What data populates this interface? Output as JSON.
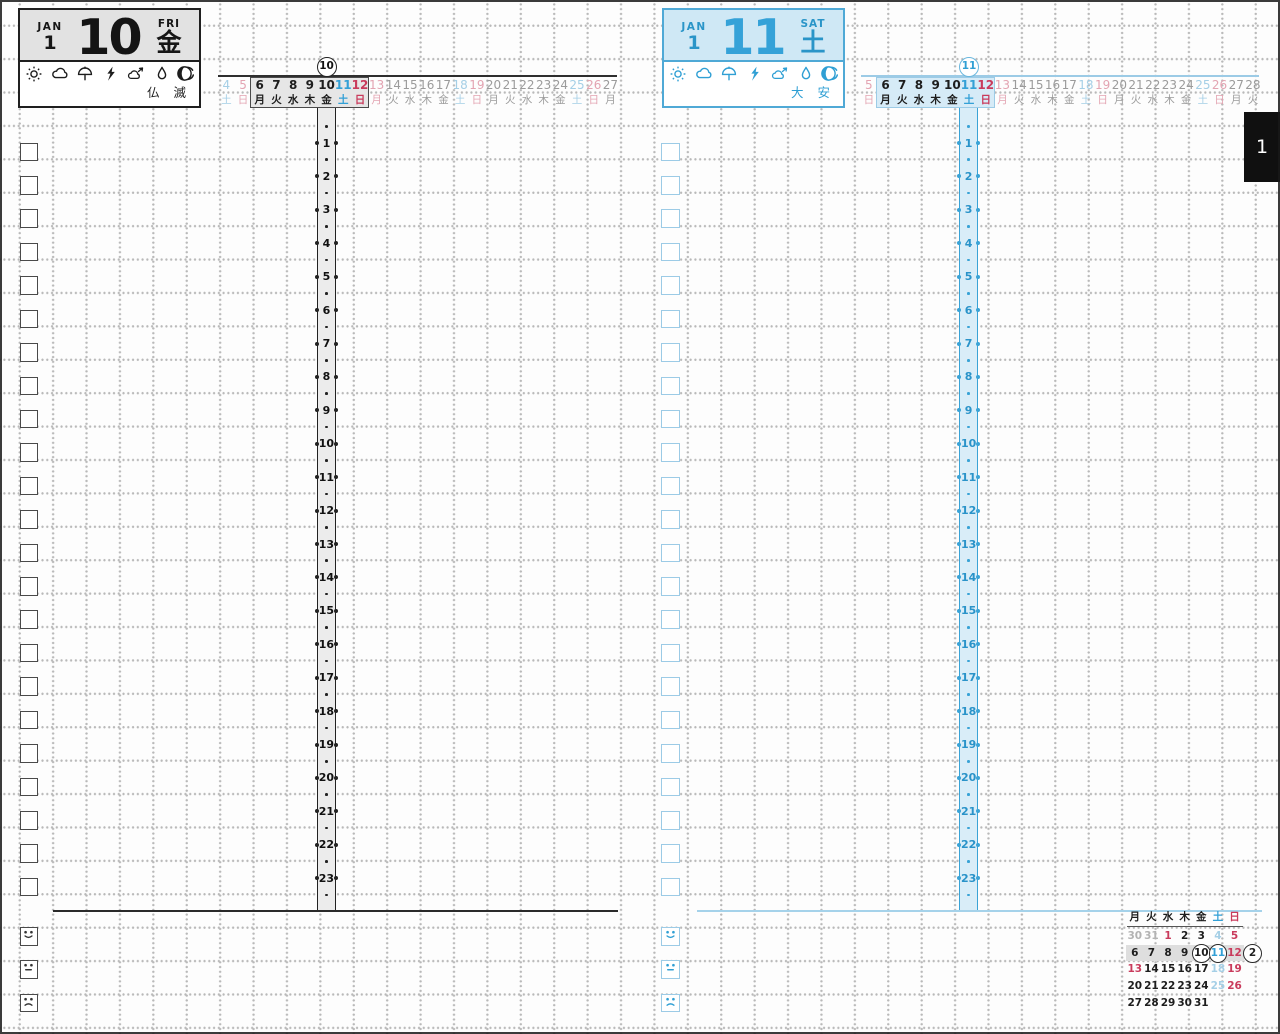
{
  "colors": {
    "ink_black": "#1d1d1d",
    "accent_blue": "#2f9fd4",
    "light_blue": "#a5cfe6",
    "blue_fill": "#d9edf8",
    "accent_red": "#c93b5c",
    "light_pink": "#e3a4b2",
    "faded_gray": "#9b9b9b",
    "gray_fill": "#e6e6e6"
  },
  "page_tab": {
    "label": "1"
  },
  "hours": [
    "1",
    "2",
    "3",
    "4",
    "5",
    "6",
    "7",
    "8",
    "9",
    "10",
    "11",
    "12",
    "13",
    "14",
    "15",
    "16",
    "17",
    "18",
    "19",
    "20",
    "21",
    "22",
    "23"
  ],
  "weather_icons": [
    "sun-icon",
    "cloud-icon",
    "umbrella-icon",
    "lightning-icon",
    "wind-cloud-icon",
    "raindrop-icon",
    "typhoon-icon"
  ],
  "moon_icon": "moon-phase-icon",
  "tracker": {
    "checkbox_count": 23,
    "moods": [
      "happy",
      "neutral",
      "sad"
    ]
  },
  "pages": {
    "left": {
      "header": {
        "month_abbr": "JAN",
        "month_num": "1",
        "day": "10",
        "weekday_abbr": "FRI",
        "weekday_kanji": "金",
        "rokuyo": "仏 滅"
      },
      "strip": {
        "circled": "10",
        "circled_index": 6,
        "week_start": 2,
        "week_len": 7,
        "cells": [
          [
            "4",
            "土",
            "satf"
          ],
          [
            "5",
            "日",
            "sunf"
          ],
          [
            "6",
            "月",
            "wk"
          ],
          [
            "7",
            "火",
            "wk"
          ],
          [
            "8",
            "水",
            "wk"
          ],
          [
            "9",
            "木",
            "wk"
          ],
          [
            "10",
            "金",
            "wk"
          ],
          [
            "11",
            "土",
            "sat"
          ],
          [
            "12",
            "日",
            "sun"
          ],
          [
            "13",
            "月",
            "sunf"
          ],
          [
            "14",
            "火",
            "g"
          ],
          [
            "15",
            "水",
            "g"
          ],
          [
            "16",
            "木",
            "g"
          ],
          [
            "17",
            "金",
            "g"
          ],
          [
            "18",
            "土",
            "satf"
          ],
          [
            "19",
            "日",
            "sunf"
          ],
          [
            "20",
            "月",
            "g"
          ],
          [
            "21",
            "火",
            "g"
          ],
          [
            "22",
            "水",
            "g"
          ],
          [
            "23",
            "木",
            "g"
          ],
          [
            "24",
            "金",
            "g"
          ],
          [
            "25",
            "土",
            "satf"
          ],
          [
            "26",
            "日",
            "sunf"
          ],
          [
            "27",
            "月",
            "g"
          ]
        ]
      }
    },
    "right": {
      "header": {
        "month_abbr": "JAN",
        "month_num": "1",
        "day": "11",
        "weekday_abbr": "SAT",
        "weekday_kanji": "土",
        "rokuyo": "大 安"
      },
      "strip": {
        "circled": "11",
        "circled_index": 6,
        "week_start": 1,
        "week_len": 7,
        "cells": [
          [
            "5",
            "日",
            "sunf"
          ],
          [
            "6",
            "月",
            "wk"
          ],
          [
            "7",
            "火",
            "wk"
          ],
          [
            "8",
            "水",
            "wk"
          ],
          [
            "9",
            "木",
            "wk"
          ],
          [
            "10",
            "金",
            "wk"
          ],
          [
            "11",
            "土",
            "sat"
          ],
          [
            "12",
            "日",
            "sun"
          ],
          [
            "13",
            "月",
            "sunf"
          ],
          [
            "14",
            "火",
            "g"
          ],
          [
            "15",
            "水",
            "g"
          ],
          [
            "16",
            "木",
            "g"
          ],
          [
            "17",
            "金",
            "g"
          ],
          [
            "18",
            "土",
            "satf"
          ],
          [
            "19",
            "日",
            "sunf"
          ],
          [
            "20",
            "月",
            "g"
          ],
          [
            "21",
            "火",
            "g"
          ],
          [
            "22",
            "水",
            "g"
          ],
          [
            "23",
            "木",
            "g"
          ],
          [
            "24",
            "金",
            "g"
          ],
          [
            "25",
            "土",
            "satf"
          ],
          [
            "26",
            "日",
            "sunf"
          ],
          [
            "27",
            "月",
            "g"
          ],
          [
            "28",
            "火",
            "g"
          ]
        ]
      }
    }
  },
  "mini_calendar": {
    "headers": [
      [
        "月",
        "wk"
      ],
      [
        "火",
        "wk"
      ],
      [
        "水",
        "wk"
      ],
      [
        "木",
        "wk"
      ],
      [
        "金",
        "wk"
      ],
      [
        "土",
        "sat"
      ],
      [
        "日",
        "sun"
      ]
    ],
    "rows": [
      [
        [
          "30",
          "gg"
        ],
        [
          "31",
          "gg"
        ],
        [
          "1",
          "sun"
        ],
        [
          "2",
          "wk"
        ],
        [
          "3",
          "wk"
        ],
        [
          "4",
          "satf"
        ],
        [
          "5",
          "sun"
        ]
      ],
      [
        [
          "6",
          "wk"
        ],
        [
          "7",
          "wk"
        ],
        [
          "8",
          "wk"
        ],
        [
          "9",
          "wk"
        ],
        [
          "10",
          "wk",
          "circle"
        ],
        [
          "11",
          "sat",
          "circle"
        ],
        [
          "12",
          "sun"
        ]
      ],
      [
        [
          "13",
          "sun"
        ],
        [
          "14",
          "wk"
        ],
        [
          "15",
          "wk"
        ],
        [
          "16",
          "wk"
        ],
        [
          "17",
          "wk"
        ],
        [
          "18",
          "satf"
        ],
        [
          "19",
          "sun"
        ]
      ],
      [
        [
          "20",
          "wk"
        ],
        [
          "21",
          "wk"
        ],
        [
          "22",
          "wk"
        ],
        [
          "23",
          "wk"
        ],
        [
          "24",
          "wk"
        ],
        [
          "25",
          "satf"
        ],
        [
          "26",
          "sun"
        ]
      ],
      [
        [
          "27",
          "wk"
        ],
        [
          "28",
          "wk"
        ],
        [
          "29",
          "wk"
        ],
        [
          "30",
          "wk"
        ],
        [
          "31",
          "wk"
        ]
      ]
    ],
    "highlight_row": 1,
    "next_month": "2"
  }
}
